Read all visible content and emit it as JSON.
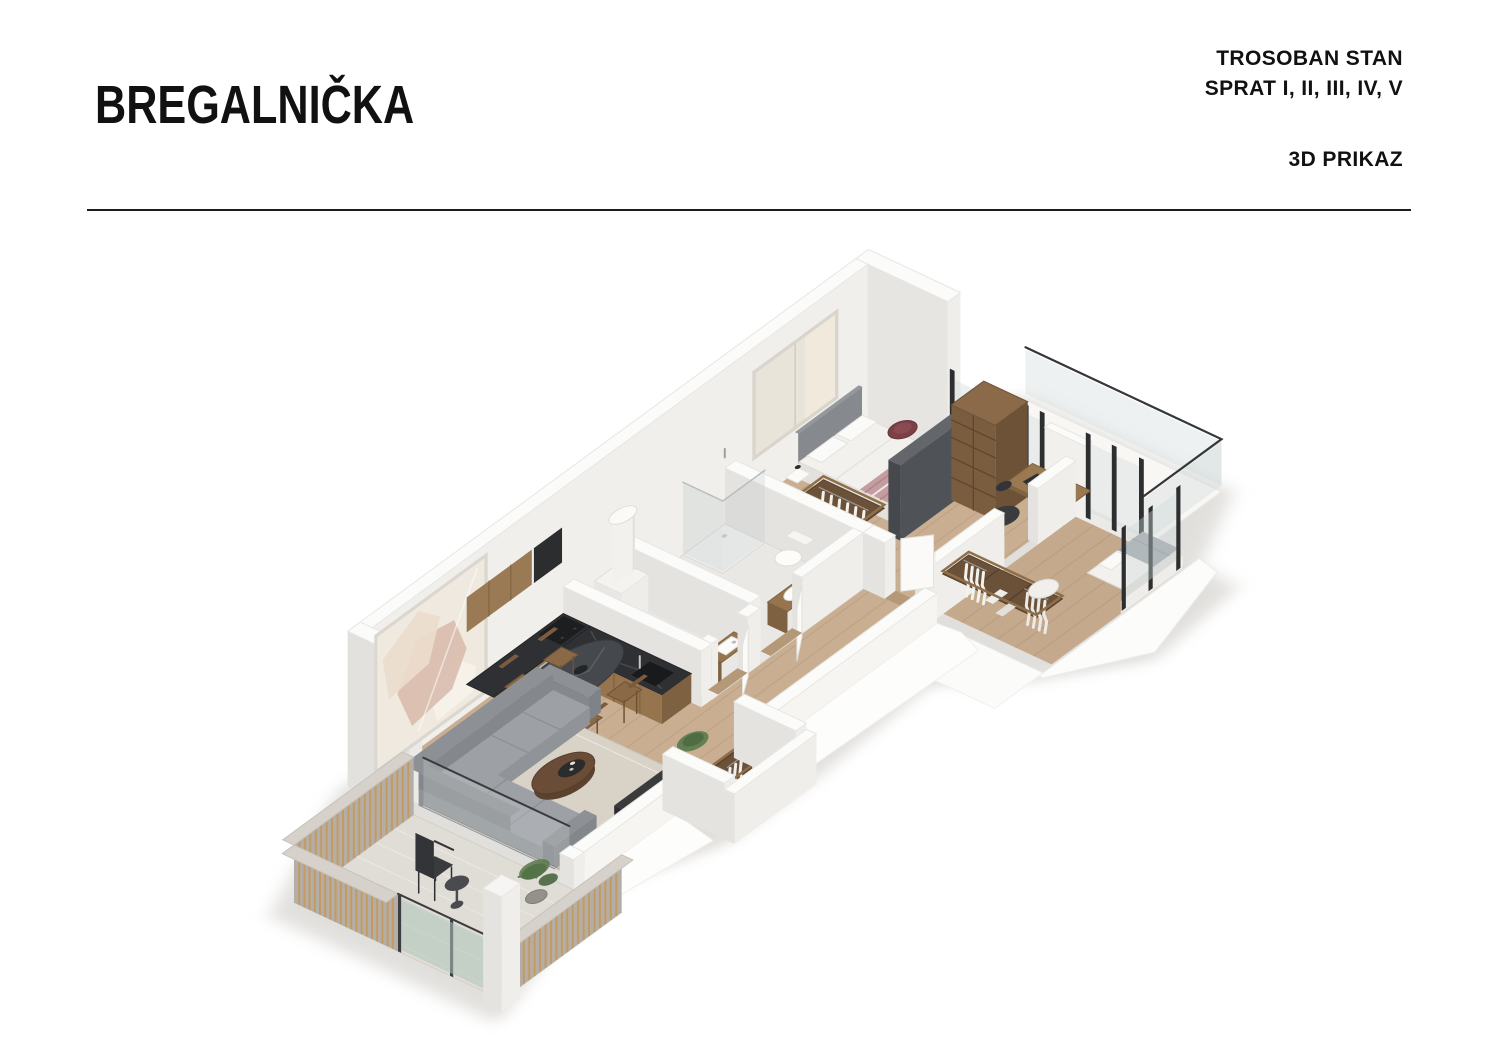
{
  "header": {
    "title": "BREGALNIČKA",
    "unit_type": "TROSOBAN STAN",
    "floors": "SPRAT I, II, III, IV, V",
    "view_label": "3D PRIKAZ"
  },
  "divider": {
    "color": "#1c1c1c"
  },
  "floorplan": {
    "view": "3d-axonometric-render",
    "rooms": [
      "loggia-balcony",
      "master-bedroom",
      "study-corner",
      "bathroom",
      "wc",
      "kitchen",
      "dining-area",
      "living-room",
      "hallway",
      "entry-vestibule",
      "second-bedroom",
      "terrace"
    ],
    "palette": {
      "background": "#ffffff",
      "ink": "#111111",
      "wood_floor": "#c9ae92",
      "wood_floor_dark": "#c4a98c",
      "tile_floor": "#eae8e4",
      "wall_top": "#fbfbfa",
      "wall_face_light": "#f0eeea",
      "wall_face_shade": "#e5e3df",
      "wall_inner": "#f1efeb",
      "wood_furniture": "#96754e",
      "wood_furniture_dark": "#6b5138",
      "counter_dark": "#2e3033",
      "sofa": "#9da0a5",
      "sofa_shade": "#8d9094",
      "rug": "#d9d3c7",
      "bed_white": "#f2f1ee",
      "blanket_rose": "#c49da1",
      "headboard_gray": "#868a8f",
      "glass_frame_dark": "#2d2e30",
      "glass_tint": "rgba(208,217,217,0.38)",
      "glass_green": "rgba(173,196,186,0.55)",
      "slat_wood": "#c49a62",
      "concrete": "#b3afa7",
      "concrete_top": "#d6d2cb",
      "plant_green": "#5e7c50",
      "table_dark": "#45484d",
      "chair_wood": "#8a6947",
      "shadow": "#c4c1bb"
    }
  }
}
